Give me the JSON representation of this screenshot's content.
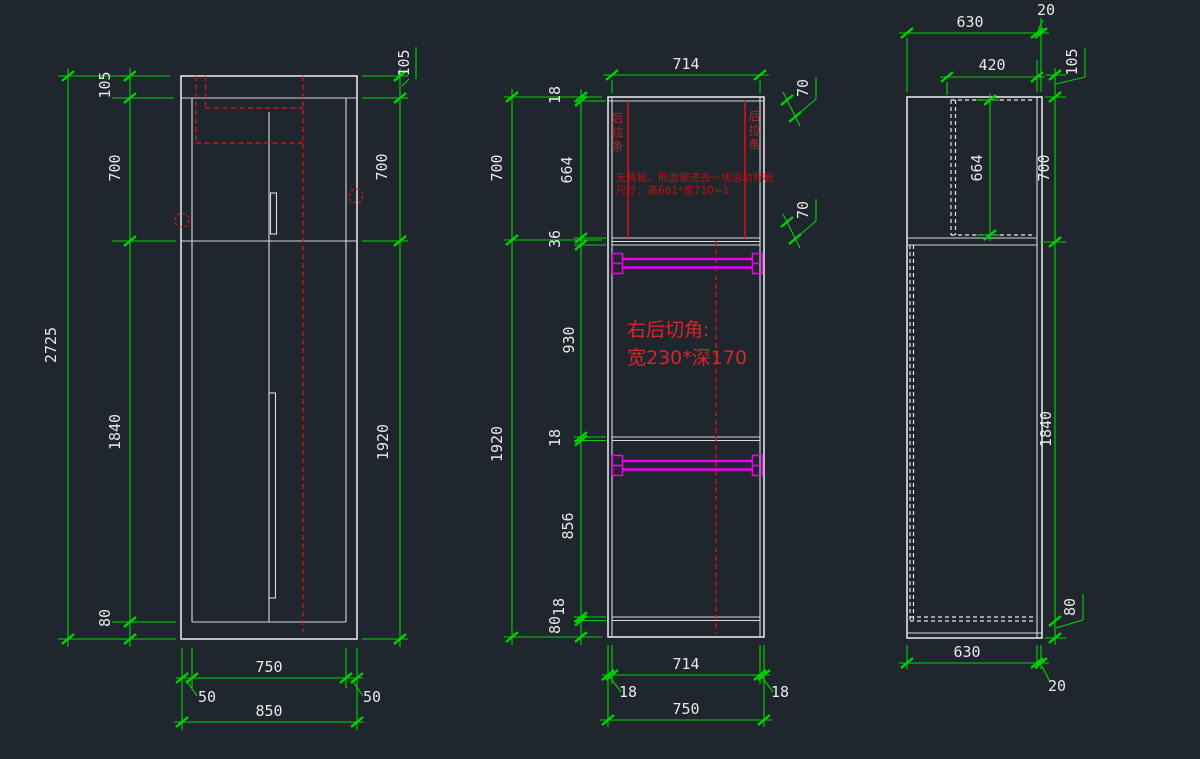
{
  "meta": {
    "type": "CAD cabinet shop drawing, three orthographic views",
    "background": "#20262e"
  },
  "colors": {
    "dimension_green": "#00d400",
    "outline_white": "#ededed",
    "hidden_red": "#e81212",
    "hardware_magenta": "#ea00ea",
    "note_red": "#bb1111"
  },
  "front": {
    "total_height": "2725",
    "top_rail": "105",
    "upper_section": "700",
    "lower_section": "1840",
    "base": "80",
    "right_top": "105",
    "right_upper": "700",
    "right_lower": "1920",
    "inner_width": "750",
    "overhang_left": "50",
    "overhang_right": "50",
    "total_width": "850"
  },
  "section": {
    "top_width": "714",
    "outer_upper": "700",
    "outer_lower": "1920",
    "chain": {
      "top_panel": "18",
      "upper_cavity": "664",
      "double_shelf": "36",
      "middle_cavity": "930",
      "shelf": "18",
      "lower_cavity": "856",
      "bottom_shelf": "18",
      "base": "80"
    },
    "flag_upper": "70",
    "flag_lower": "70",
    "strip_left": "后拉条",
    "strip_right": "后拉条",
    "note_line1": "无背板，前面塞进去一块活动背板",
    "note_line2": "尺寸：高661*宽710=1",
    "cut_line1": "右后切角:",
    "cut_line2": "宽230*深170",
    "bottom_width": "714",
    "bottom_side_left": "18",
    "bottom_side_right": "18",
    "bottom_total": "750"
  },
  "side": {
    "depth_top": "630",
    "front_gap_top": "20",
    "back_panel_offset": "420",
    "crown": "105",
    "back_panel_height": "664",
    "upper": "700",
    "lower": "1840",
    "base": "80",
    "depth_bottom": "630",
    "front_gap_bottom": "20"
  }
}
